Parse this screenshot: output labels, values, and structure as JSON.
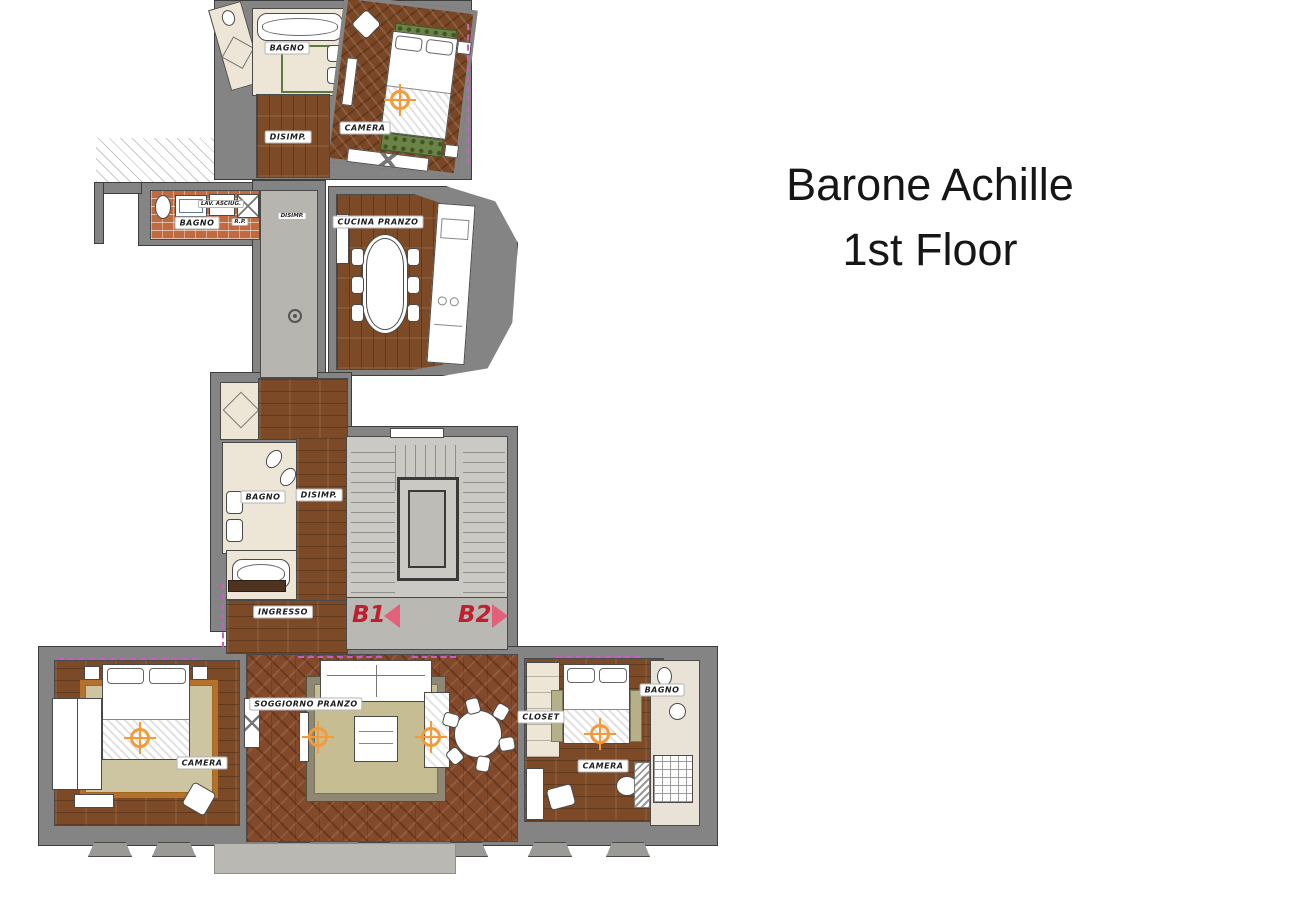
{
  "title": {
    "line1": "Barone Achille",
    "line2": "1st Floor"
  },
  "rooms": {
    "bagno_top": {
      "label": "BAGNO"
    },
    "camera_top": {
      "label": "CAMERA"
    },
    "disimp_top": {
      "label": "DISIMP."
    },
    "bagno_laundry": {
      "label": "BAGNO"
    },
    "lav_asciug": {
      "label": "LAV. ASCIUG."
    },
    "rp": {
      "label": "R.P."
    },
    "disimp_landing": {
      "label": "DISIMP."
    },
    "cucina": {
      "label": "CUCINA PRANZO"
    },
    "bagno_mid": {
      "label": "BAGNO"
    },
    "disimp_mid": {
      "label": "DISIMP."
    },
    "ingresso": {
      "label": "INGRESSO"
    },
    "camera_left": {
      "label": "CAMERA"
    },
    "soggiorno": {
      "label": "SOGGIORNO PRANZO"
    },
    "closet": {
      "label": "CLOSET"
    },
    "camera_right": {
      "label": "CAMERA"
    },
    "bagno_right": {
      "label": "BAGNO"
    }
  },
  "stairwell": {
    "b1": "B1",
    "b2": "B2"
  },
  "markers": {
    "type": "target-crosshair",
    "color": "#F29B38",
    "count": 5
  },
  "colors": {
    "wall": "#848484",
    "wood": "#7C4A27",
    "parquet": "#83492B",
    "stair": "#CAC9C4",
    "accent_red": "#C0202E",
    "arrow_pink": "#E2607A",
    "rug_green": "#6B8347",
    "rug_beige": "#CDC5A2",
    "window_marker": "#C75FC2"
  }
}
